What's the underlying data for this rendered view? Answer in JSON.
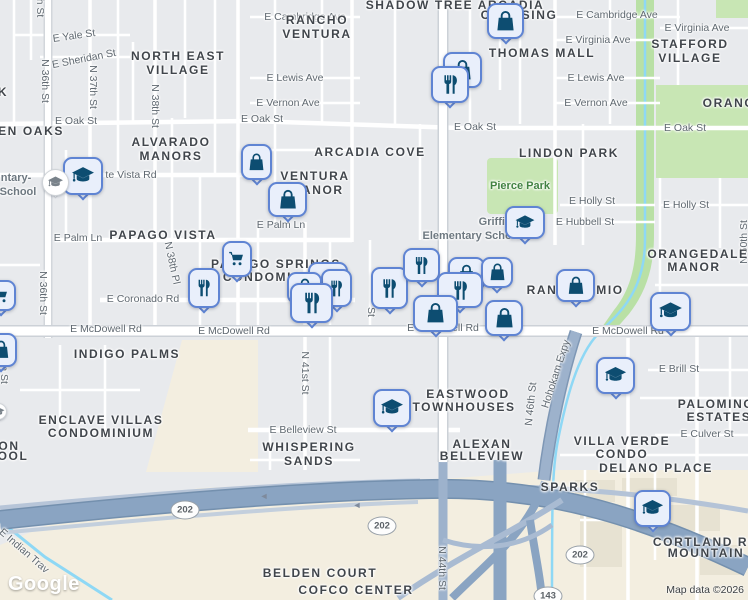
{
  "map": {
    "logo": "Google",
    "attribution": "Map data ©2026",
    "colors": {
      "background": "#e8eaed",
      "pin_fill": "#e9effb",
      "pin_stroke": "#5f84d3",
      "pin_icon": "#0d4d71",
      "park_green": "#c8e6b4",
      "greenbelt": "#b9e0a5",
      "freeway_blue": "#8aa4c2",
      "canal_blue": "#8ed8f5",
      "beige": "#f3eee0",
      "street_label": "#5f6870",
      "area_label": "#40454b",
      "park_label": "#418241"
    },
    "street_labels": [
      {
        "text": "E Cambridge Ave",
        "x": 305,
        "y": 17
      },
      {
        "text": "E Cambridge Ave",
        "x": 617,
        "y": 15
      },
      {
        "text": "E Virginia Ave",
        "x": 598,
        "y": 40
      },
      {
        "text": "E Virginia Ave",
        "x": 697,
        "y": 28
      },
      {
        "text": "E Yale St",
        "x": 74,
        "y": 36,
        "rot": -8
      },
      {
        "text": "E Sheridan St",
        "x": 84,
        "y": 59,
        "rot": -11
      },
      {
        "text": "E Lewis Ave",
        "x": 295,
        "y": 78
      },
      {
        "text": "E Lewis Ave",
        "x": 596,
        "y": 78
      },
      {
        "text": "E Vernon Ave",
        "x": 288,
        "y": 103
      },
      {
        "text": "E Vernon Ave",
        "x": 596,
        "y": 103
      },
      {
        "text": "E Oak St",
        "x": 76,
        "y": 121
      },
      {
        "text": "E Oak St",
        "x": 262,
        "y": 119
      },
      {
        "text": "E Oak St",
        "x": 475,
        "y": 127
      },
      {
        "text": "E Oak St",
        "x": 685,
        "y": 128
      },
      {
        "text": "te Vista Rd",
        "x": 131,
        "y": 175
      },
      {
        "text": "E Palm Ln",
        "x": 78,
        "y": 238
      },
      {
        "text": "E Palm Ln",
        "x": 281,
        "y": 225
      },
      {
        "text": "E Holly St",
        "x": 592,
        "y": 201
      },
      {
        "text": "E Holly St",
        "x": 686,
        "y": 205
      },
      {
        "text": "E Hubbell St",
        "x": 585,
        "y": 222
      },
      {
        "text": "E Coronado Rd",
        "x": 143,
        "y": 299
      },
      {
        "text": "E McDowell Rd",
        "x": 106,
        "y": 329
      },
      {
        "text": "E McDowell Rd",
        "x": 234,
        "y": 331
      },
      {
        "text": "E McDowell Rd",
        "x": 443,
        "y": 328
      },
      {
        "text": "E McDowell Rd",
        "x": 628,
        "y": 331
      },
      {
        "text": "E Brill St",
        "x": 679,
        "y": 369
      },
      {
        "text": "E Culver St",
        "x": 707,
        "y": 434
      },
      {
        "text": "E Belleview St",
        "x": 303,
        "y": 430
      },
      {
        "text": "N 36th St",
        "x": 45,
        "y": 81,
        "rot": 90
      },
      {
        "text": "N 37th St",
        "x": 93,
        "y": 87,
        "rot": 90
      },
      {
        "text": "N 38th St",
        "x": 155,
        "y": 106,
        "rot": 90
      },
      {
        "text": "N 36th St",
        "x": 43,
        "y": 293,
        "rot": 90
      },
      {
        "text": "N 41st St",
        "x": 305,
        "y": 373,
        "rot": 90
      },
      {
        "text": "N 38th Pl",
        "x": 172,
        "y": 263,
        "rot": 78
      },
      {
        "text": "N 50th St",
        "x": 744,
        "y": 242,
        "rot": -90
      },
      {
        "text": "N 46th St",
        "x": 531,
        "y": 404,
        "rot": -84
      },
      {
        "text": "N 44th St",
        "x": 442,
        "y": 568,
        "rot": 90
      },
      {
        "text": "N 35th St",
        "x": 4,
        "y": 362,
        "rot": 90
      },
      {
        "text": "h St",
        "x": 40,
        "y": 8,
        "rot": 90
      },
      {
        "text": "St",
        "x": 371,
        "y": 312,
        "rot": 90
      },
      {
        "text": "Hohokam Expy",
        "x": 556,
        "y": 374,
        "rot": -72
      },
      {
        "text": "E Indian Trav",
        "x": 24,
        "y": 551,
        "rot": 41
      }
    ],
    "area_labels": [
      {
        "text": "SHADOW TREE ARCADIA",
        "x": 455,
        "y": 5
      },
      {
        "text": "CROSSING",
        "x": 519,
        "y": 15
      },
      {
        "text": "RANCHO",
        "x": 317,
        "y": 20
      },
      {
        "text": "VENTURA",
        "x": 317,
        "y": 34
      },
      {
        "text": "NORTH EAST",
        "x": 178,
        "y": 56
      },
      {
        "text": "VILLAGE",
        "x": 178,
        "y": 70
      },
      {
        "text": "STAFFORD",
        "x": 690,
        "y": 44
      },
      {
        "text": "VILLAGE",
        "x": 690,
        "y": 58
      },
      {
        "text": "THOMAS MALL",
        "x": 542,
        "y": 53
      },
      {
        "text": "EN OAKS",
        "x": 31,
        "y": 131
      },
      {
        "text": "ALVARADO",
        "x": 171,
        "y": 142
      },
      {
        "text": "MANORS",
        "x": 171,
        "y": 156
      },
      {
        "text": "ARCADIA COVE",
        "x": 370,
        "y": 152
      },
      {
        "text": "VENTURA",
        "x": 315,
        "y": 176
      },
      {
        "text": "MANOR",
        "x": 317,
        "y": 190
      },
      {
        "text": "LINDON PARK",
        "x": 569,
        "y": 153
      },
      {
        "text": "PAPAGO VISTA",
        "x": 163,
        "y": 235
      },
      {
        "text": "PAPAGO SPRINGS",
        "x": 276,
        "y": 264
      },
      {
        "text": "CONDOMINIUM",
        "x": 276,
        "y": 277
      },
      {
        "text": "ORANGEDALE",
        "x": 698,
        "y": 254
      },
      {
        "text": "MANOR",
        "x": 694,
        "y": 267
      },
      {
        "text": "ORANG",
        "x": 729,
        "y": 103
      },
      {
        "text": "RAN",
        "x": 542,
        "y": 290
      },
      {
        "text": "MIO",
        "x": 610,
        "y": 290
      },
      {
        "text": "INDIGO PALMS",
        "x": 127,
        "y": 354
      },
      {
        "text": "ENCLAVE VILLAS",
        "x": 101,
        "y": 420
      },
      {
        "text": "CONDOMINIUM",
        "x": 101,
        "y": 433
      },
      {
        "text": "ON",
        "x": 9,
        "y": 446
      },
      {
        "text": "OOL",
        "x": 13,
        "y": 456
      },
      {
        "text": "EASTWOOD",
        "x": 468,
        "y": 394
      },
      {
        "text": "TOWNHOUSES",
        "x": 464,
        "y": 407
      },
      {
        "text": "WHISPERING",
        "x": 309,
        "y": 447
      },
      {
        "text": "SANDS",
        "x": 309,
        "y": 461
      },
      {
        "text": "ALEXAN",
        "x": 482,
        "y": 444
      },
      {
        "text": "BELLEVIEW",
        "x": 482,
        "y": 456
      },
      {
        "text": "VILLA VERDE",
        "x": 622,
        "y": 441
      },
      {
        "text": "CONDO",
        "x": 622,
        "y": 454
      },
      {
        "text": "DELANO PLACE",
        "x": 656,
        "y": 468
      },
      {
        "text": "SPARKS",
        "x": 570,
        "y": 487
      },
      {
        "text": "PALOMINO",
        "x": 716,
        "y": 404
      },
      {
        "text": "ESTATES",
        "x": 719,
        "y": 417
      },
      {
        "text": "CORTLAND RI",
        "x": 703,
        "y": 542
      },
      {
        "text": "MOUNTAIN",
        "x": 706,
        "y": 553
      },
      {
        "text": "BELDEN COURT",
        "x": 320,
        "y": 573
      },
      {
        "text": "COFCO CENTER",
        "x": 356,
        "y": 590
      },
      {
        "text": "K",
        "x": 3,
        "y": 92
      }
    ],
    "park_labels": [
      {
        "text": "Pierce Park",
        "x": 520,
        "y": 186
      }
    ],
    "poi_labels": [
      {
        "text": "Griffith",
        "x": 497,
        "y": 222
      },
      {
        "text": "Elementary School",
        "x": 472,
        "y": 236
      },
      {
        "text": "ntary-",
        "x": 16,
        "y": 178
      },
      {
        "text": "School",
        "x": 18,
        "y": 192
      }
    ],
    "shields": [
      {
        "label": "202",
        "x": 185,
        "y": 510
      },
      {
        "label": "202",
        "x": 382,
        "y": 526
      },
      {
        "label": "202",
        "x": 580,
        "y": 555
      },
      {
        "label": "143",
        "x": 548,
        "y": 596
      }
    ],
    "ramp_arrows": [
      {
        "x": 264,
        "y": 496
      },
      {
        "x": 357,
        "y": 505
      }
    ],
    "markers": [
      {
        "type": "shopping-bag",
        "icon": "shopping-bag-icon",
        "x": 487,
        "y": 3,
        "w": 37,
        "h": 36
      },
      {
        "type": "shopping-bag",
        "icon": "shopping-bag-icon",
        "x": 443,
        "y": 52,
        "w": 39,
        "h": 36
      },
      {
        "type": "restaurant",
        "icon": "fork-knife-icon",
        "x": 431,
        "y": 66,
        "w": 38,
        "h": 37
      },
      {
        "type": "school",
        "icon": "graduation-cap-icon",
        "x": 63,
        "y": 157,
        "w": 40,
        "h": 38
      },
      {
        "type": "shopping-bag",
        "icon": "shopping-bag-icon",
        "x": 241,
        "y": 144,
        "w": 31,
        "h": 36
      },
      {
        "type": "shopping-bag",
        "icon": "shopping-bag-icon",
        "x": 268,
        "y": 182,
        "w": 39,
        "h": 35
      },
      {
        "type": "cart",
        "icon": "shopping-cart-icon",
        "x": 222,
        "y": 241,
        "w": 30,
        "h": 36
      },
      {
        "type": "restaurant",
        "icon": "fork-knife-icon",
        "x": 188,
        "y": 268,
        "w": 32,
        "h": 40
      },
      {
        "type": "shopping-bag",
        "icon": "shopping-bag-icon",
        "x": 308,
        "y": 262,
        "w": 40,
        "h": 34
      },
      {
        "type": "restaurant",
        "icon": "fork-knife-icon",
        "x": 321,
        "y": 269,
        "w": 31,
        "h": 38
      },
      {
        "type": "shopping-bag",
        "icon": "shopping-bag-icon",
        "x": 287,
        "y": 272,
        "w": 35,
        "h": 32
      },
      {
        "type": "restaurant",
        "icon": "fork-knife-icon",
        "x": 290,
        "y": 283,
        "w": 43,
        "h": 40
      },
      {
        "type": "restaurant",
        "icon": "fork-knife-icon",
        "x": 371,
        "y": 267,
        "w": 37,
        "h": 42
      },
      {
        "type": "restaurant",
        "icon": "fork-knife-icon",
        "x": 403,
        "y": 248,
        "w": 37,
        "h": 34
      },
      {
        "type": "shopping-bag",
        "icon": "shopping-bag-icon",
        "x": 448,
        "y": 257,
        "w": 37,
        "h": 34
      },
      {
        "type": "shopping-bag",
        "icon": "shopping-bag-icon",
        "x": 481,
        "y": 257,
        "w": 32,
        "h": 31
      },
      {
        "type": "restaurant",
        "icon": "fork-knife-icon",
        "x": 437,
        "y": 272,
        "w": 46,
        "h": 36
      },
      {
        "type": "shopping-bag",
        "icon": "shopping-bag-icon",
        "x": 413,
        "y": 295,
        "w": 45,
        "h": 37
      },
      {
        "type": "shopping-bag",
        "icon": "shopping-bag-icon",
        "x": 485,
        "y": 300,
        "w": 38,
        "h": 36
      },
      {
        "type": "school",
        "icon": "graduation-cap-icon",
        "x": 505,
        "y": 206,
        "w": 40,
        "h": 33
      },
      {
        "type": "shopping-bag",
        "icon": "shopping-bag-icon",
        "x": 556,
        "y": 269,
        "w": 39,
        "h": 33
      },
      {
        "type": "school",
        "icon": "graduation-cap-icon",
        "x": 650,
        "y": 292,
        "w": 41,
        "h": 39
      },
      {
        "type": "cart",
        "icon": "shopping-cart-icon",
        "x": -14,
        "y": 280,
        "w": 30,
        "h": 31
      },
      {
        "type": "shopping-bag",
        "icon": "shopping-bag-icon",
        "x": -16,
        "y": 333,
        "w": 33,
        "h": 34
      },
      {
        "type": "school",
        "icon": "graduation-cap-icon",
        "x": 596,
        "y": 357,
        "w": 39,
        "h": 37
      },
      {
        "type": "school",
        "icon": "graduation-cap-icon",
        "x": 373,
        "y": 389,
        "w": 38,
        "h": 38
      },
      {
        "type": "school",
        "icon": "graduation-cap-icon",
        "x": 634,
        "y": 490,
        "w": 37,
        "h": 37
      },
      {
        "type": "school-circle",
        "icon": "graduation-cap-icon",
        "x": 42,
        "y": 169,
        "w": 27,
        "h": 27
      },
      {
        "type": "school-circle",
        "icon": "graduation-cap-icon",
        "x": -10,
        "y": 403,
        "w": 17,
        "h": 17
      }
    ]
  }
}
